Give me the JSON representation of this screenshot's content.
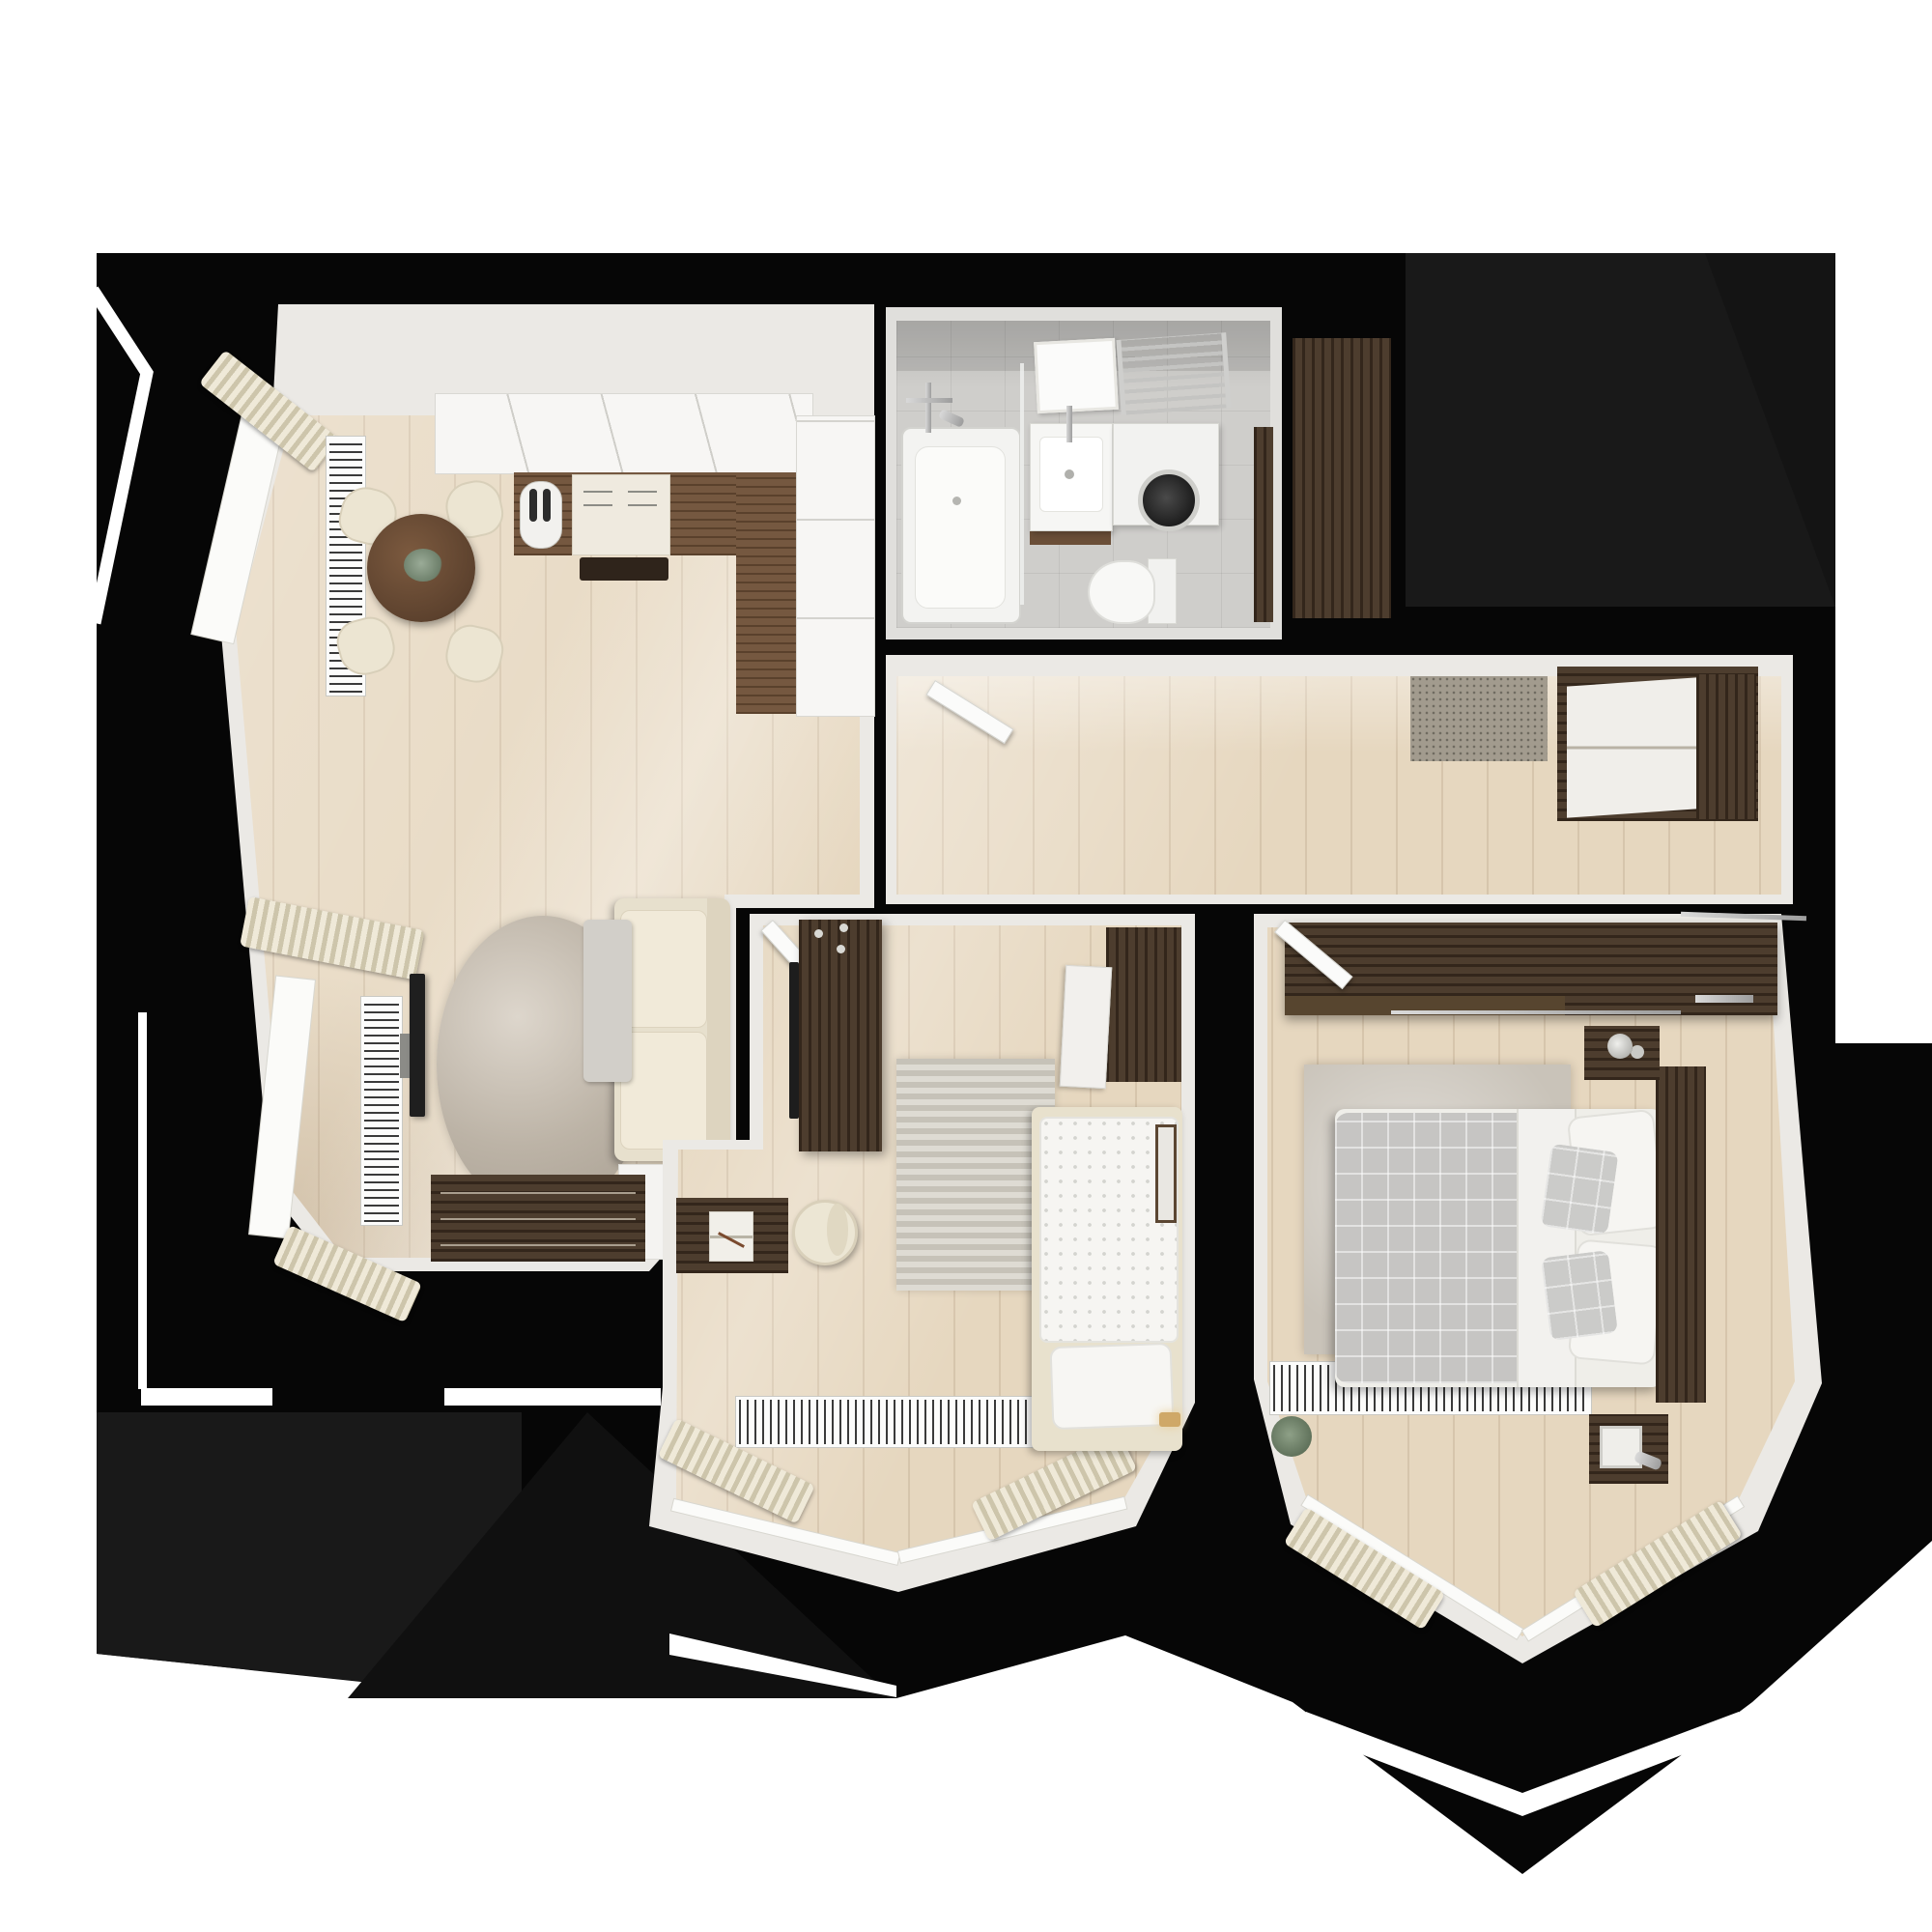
{
  "scene": {
    "kind": "floor-plan-3d-render",
    "view": "top-down",
    "background": "white canvas with black render silhouette",
    "rooms_count": 5
  },
  "palette": {
    "canvas_white": "#ffffff",
    "render_black": "#060606",
    "render_black_soft": "#191919",
    "wall_white": "#ebe9e5",
    "floor_wood": "#e6d7bf",
    "wood_dark": "#463525",
    "wood_counter": "#6e4f36",
    "fabric_cream": "#ece5d2",
    "curtain_beige": "#d9d2bc",
    "rug_gray": "#c9c3b9",
    "tile_gray": "#cfcecb",
    "chrome_gray": "#b9b9b9",
    "plant_green": "#7d8c74"
  },
  "rooms": [
    {
      "id": "living-kitchen",
      "position": "top-left",
      "furniture": [
        "kitchen-upper-cabinets",
        "kitchen-countertop",
        "cooktop",
        "kettle",
        "range-hood",
        "kitchen-tall-cabinet",
        "dining-table",
        "dining-chair-1",
        "dining-chair-2",
        "dining-chair-3",
        "dining-chair-4",
        "table-plant",
        "window-radiator-upper",
        "window-radiator-lower",
        "bay-window-upper",
        "bay-window-lower",
        "curtains",
        "tv",
        "tv-stand",
        "round-rug",
        "sofa",
        "throw-blanket",
        "side-table",
        "sideboard"
      ]
    },
    {
      "id": "bathroom",
      "position": "top-center",
      "furniture": [
        "bathtub",
        "shower-mixer",
        "glass-screen",
        "mirror",
        "washbasin",
        "vanity",
        "towel-radiator",
        "washing-machine",
        "toilet",
        "bathroom-door",
        "hall-closet"
      ]
    },
    {
      "id": "hallway",
      "position": "middle",
      "furniture": [
        "open-bathroom-door",
        "doormat",
        "hall-wardrobe"
      ]
    },
    {
      "id": "bedroom-small",
      "position": "bottom-center",
      "furniture": [
        "wardrobe-with-tv",
        "tv-panel",
        "overbed-cabinet",
        "cabinet-door-open",
        "single-bed",
        "duvet",
        "pillow",
        "striped-rug",
        "desk",
        "notebook",
        "desk-chair",
        "bay-radiator",
        "bay-window",
        "curtains",
        "picture-frame",
        "wall-lamp",
        "door-leaf"
      ]
    },
    {
      "id": "bedroom-master",
      "position": "bottom-right",
      "furniture": [
        "sliding-wardrobe",
        "wardrobe-handle",
        "double-bed",
        "headboard",
        "plaid-blanket",
        "duvet-fold",
        "pillow-1",
        "pillow-2",
        "plaid-pillow-1",
        "plaid-pillow-2",
        "nightstand-top",
        "lamp-top",
        "nightstand-bottom",
        "lamp-bottom",
        "area-rug",
        "bay-radiator",
        "bay-window",
        "curtains",
        "plant",
        "door-leaf"
      ]
    }
  ]
}
